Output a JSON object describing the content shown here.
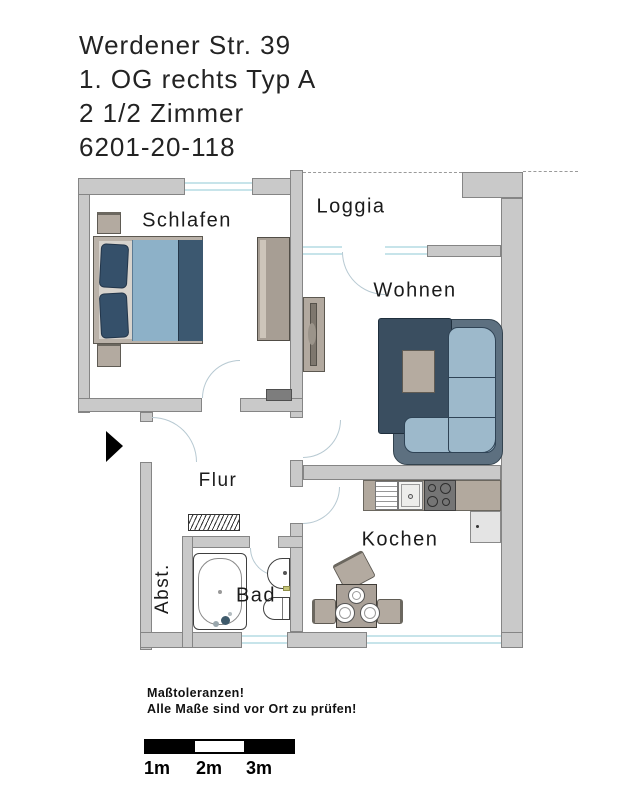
{
  "title": {
    "line1": "Werdener Str. 39",
    "line2": "1. OG rechts Typ A",
    "line3": "2 1/2 Zimmer",
    "line4": "6201-20-118"
  },
  "rooms": {
    "schlafen": "Schlafen",
    "loggia": "Loggia",
    "wohnen": "Wohnen",
    "flur": "Flur",
    "kochen": "Kochen",
    "bad": "Bad",
    "abst": "Abst."
  },
  "notes": {
    "line1": "Maßtoleranzen!",
    "line2": "Alle Maße sind vor Ort zu prüfen!"
  },
  "scale_bar": {
    "labels": [
      "1m",
      "2m",
      "3m"
    ]
  },
  "colors": {
    "wall_gray": "#c9c9c9",
    "sofa_navy": "#3a4e60",
    "sofa_light_blue": "#9db9cb",
    "bed_blanket_blue": "#8db1c8",
    "furniture_taupe": "#b3aaa0",
    "window_cyan": "#c7e4ea"
  }
}
